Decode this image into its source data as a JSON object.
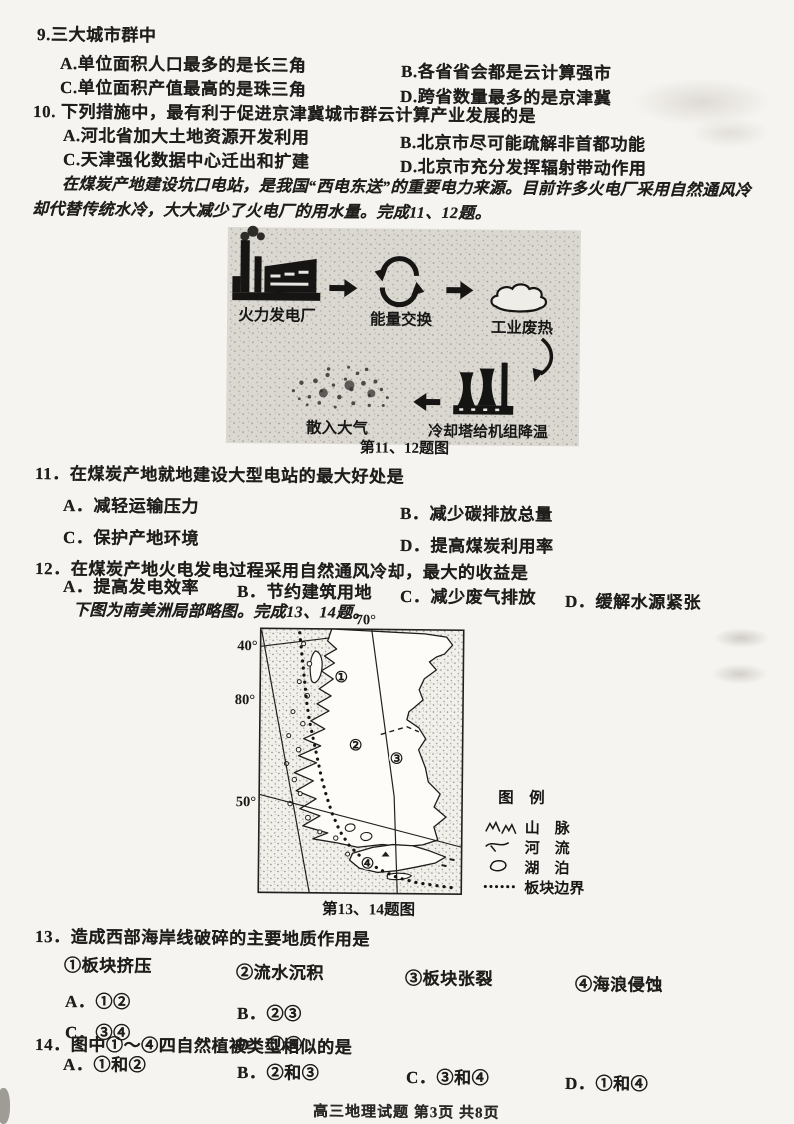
{
  "q9": {
    "stem": "9.三大城市群中",
    "a": "A.单位面积人口最多的是长三角",
    "b": "B.各省省会都是云计算强市",
    "c": "C.单位面积产值最高的是珠三角",
    "d": "D.跨省数量最多的是京津冀"
  },
  "q10": {
    "stem": "10. 下列措施中，最有利于促进京津冀城市群云计算产业发展的是",
    "a": "A.河北省加大土地资源开发利用",
    "b": "B.北京市尽可能疏解非首都功能",
    "c": "C.天津强化数据中心迁出和扩建",
    "d": "D.北京市充分发挥辐射带动作用"
  },
  "passage_coal": {
    "line1": "在煤炭产地建设坑口电站，是我国“西电东送”的重要电力来源。目前许多火电厂采用自然通风冷",
    "line2": "却代替传统水冷，大大减少了火电厂的用水量。完成11、12题。"
  },
  "diagram": {
    "plant": "火力发电厂",
    "exchange": "能量交换",
    "waste": "工业废热",
    "air": "散入大气",
    "cool": "冷却塔给机组降温",
    "caption": "第11、12题图"
  },
  "q11": {
    "stem": "11．在煤炭产地就地建设大型电站的最大好处是",
    "a": "A．减轻运输压力",
    "b": "B．减少碳排放总量",
    "c": "C．保护产地环境",
    "d": "D．提高煤炭利用率"
  },
  "q12": {
    "stem": "12．在煤炭产地火电发电过程采用自然通风冷却，最大的收益是",
    "a": "A．提高发电效率",
    "b": "B．节约建筑用地",
    "c": "C．减少废气排放",
    "d": "D．缓解水源紧张"
  },
  "passage_map": "下图为南美洲局部略图。完成13、14题。",
  "map": {
    "lon70": "70°",
    "lat40": "40°",
    "lon80": "80°",
    "lat50": "50°",
    "m1": "①",
    "m2": "②",
    "m3": "③",
    "m4": "④",
    "legend_title": "图　例",
    "legend_mountain": "山　脉",
    "legend_river": "河　流",
    "legend_lake": "湖　泊",
    "legend_plate": "板块边界",
    "caption": "第13、14题图"
  },
  "q13": {
    "stem": "13．造成西部海岸线破碎的主要地质作用是",
    "i1": "①板块挤压",
    "i2": "②流水沉积",
    "i3": "③板块张裂",
    "i4": "④海浪侵蚀",
    "a": "A．①②",
    "b": "B．②③",
    "c": "C．③④",
    "d": "D．①④"
  },
  "q14": {
    "stem": "14．图中①～④四自然植被类型相似的是",
    "a": "A．①和②",
    "b": "B．②和③",
    "c": "C．③和④",
    "d": "D．①和④"
  },
  "footer": "高三地理试题 第3页 共8页"
}
